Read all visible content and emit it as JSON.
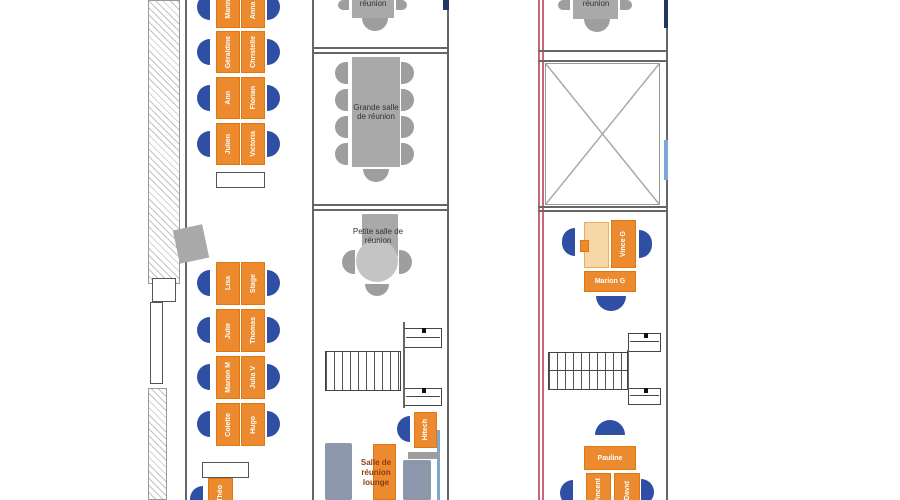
{
  "app": {
    "type": "office seating floor plan",
    "language": "fr"
  },
  "colors": {
    "desk": "#EB8A2F",
    "desk_border": "#E0780F",
    "vacant_desk": "#F6D7A8",
    "chair_blue": "#2E4FA3",
    "meeting_table_gray": "#A9A9A9",
    "meeting_chair_gray": "#9E9E9E",
    "couch_gray_blue": "#8D97AB",
    "wall_gray": "#666666",
    "wall_pink": "#C4687A",
    "wall_navy": "#1F3864",
    "wall_light_blue": "#7BA7D7",
    "lounge_text": "#8C3D10"
  },
  "left_zone": {
    "bank1": {
      "rows": [
        {
          "left": "Marine",
          "right": "Anna P"
        },
        {
          "left": "Géraldine",
          "right": "Christelle"
        },
        {
          "left": "Ann",
          "right": "Florian"
        },
        {
          "left": "Julien",
          "right": "Victoria"
        }
      ]
    },
    "bank2": {
      "rows": [
        {
          "left": "Lisa",
          "right": "Stage"
        },
        {
          "left": "Julie",
          "right": "Thomas"
        },
        {
          "left": "Marion M",
          "right": "Julia V"
        },
        {
          "left": "Colette",
          "right": "Hugo"
        }
      ]
    },
    "corner_desk": {
      "name": "Théo"
    }
  },
  "middle_zone": {
    "top_room_label": "réunion",
    "grande_salle_label": "Grande salle de réunion",
    "petite_salle_label": "Petite salle de réunion",
    "lounge_label": "Salle de réunion lounge",
    "desk_hitech": "Hitech"
  },
  "right_zone": {
    "top_room_label": "réunion",
    "cluster1": {
      "desk_vertical": "Vince G",
      "desk_horizontal": "Marion G"
    },
    "cluster2": {
      "desk_top": "Pauline",
      "desk_left": "Vincent",
      "desk_right": "David"
    }
  }
}
